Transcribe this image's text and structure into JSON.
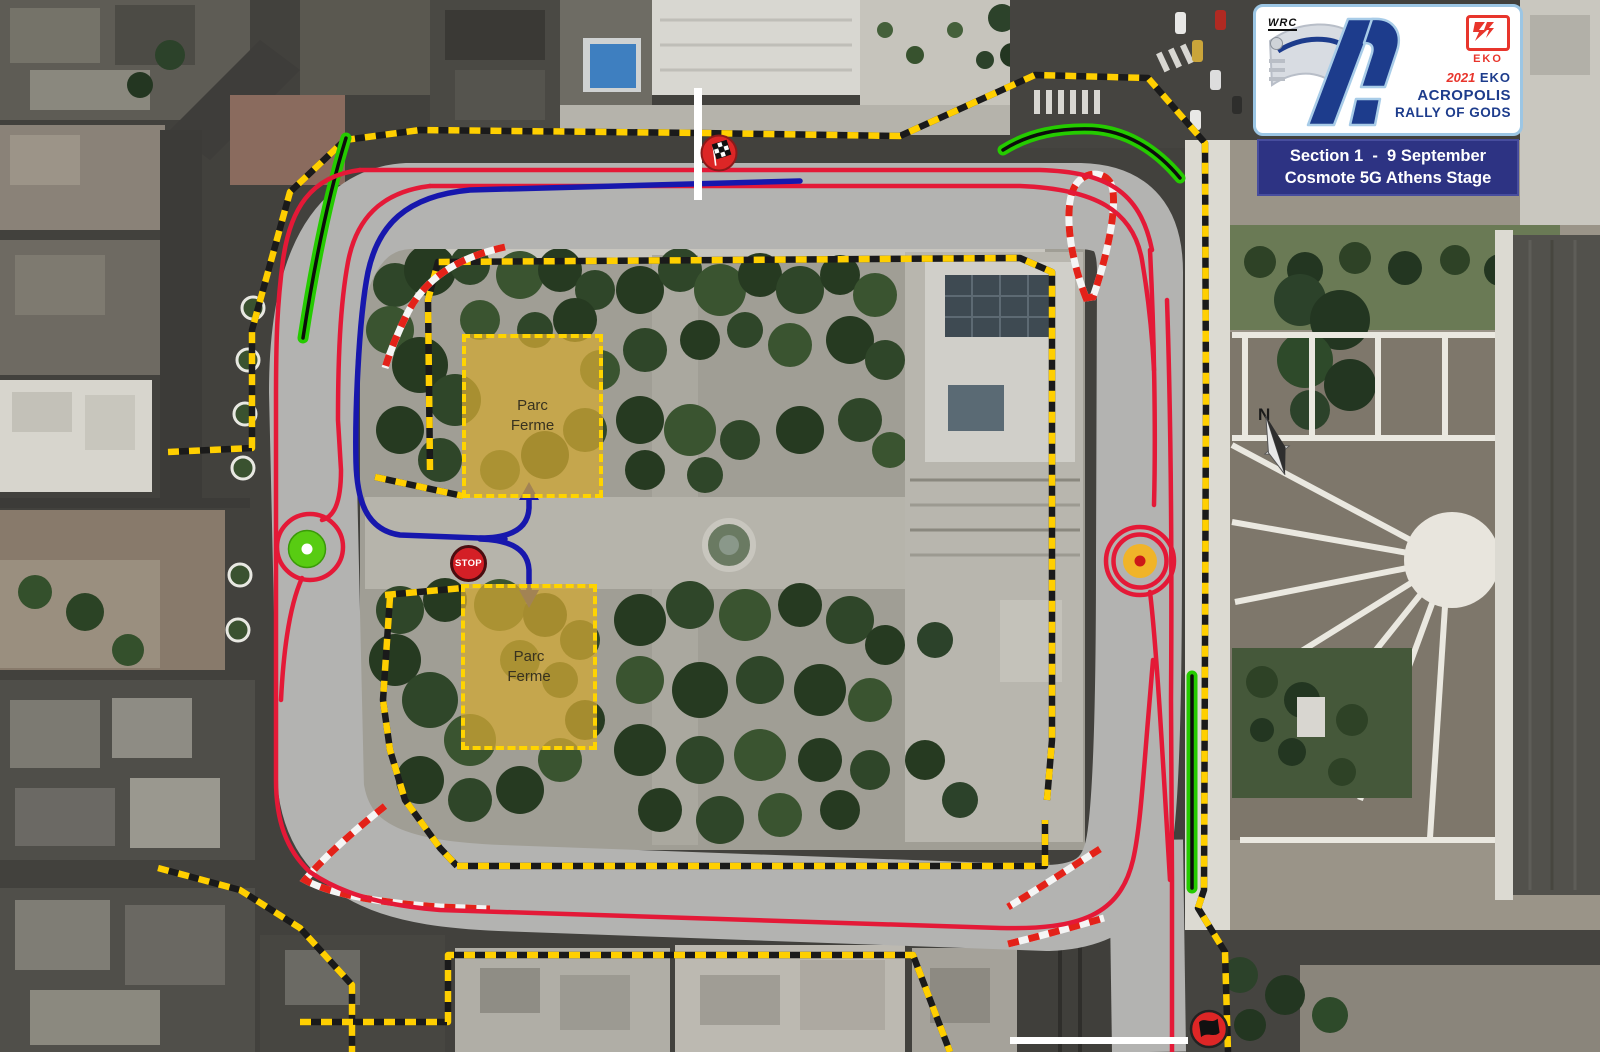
{
  "stage_card": {
    "wrc_mark": "WRC",
    "year": "2021",
    "sponsor": "EKO",
    "title_line1": "ACROPOLIS",
    "title_line2": "RALLY OF GODS",
    "eko_logo_text": "EKO",
    "section_line": "Section 1  -  9 September",
    "stage_line": "Cosmote 5G Athens Stage"
  },
  "map": {
    "labels": {
      "parc_ferme_upper": "Parc\nFerme",
      "parc_ferme_lower": "Parc\nFerme",
      "stop_control": "STOP",
      "north": "N"
    },
    "icons": [
      "checkered-flag-icon",
      "stop-sign-icon",
      "start-control-green-icon",
      "regroup-control-orange-icon",
      "black-flag-icon",
      "north-compass-icon"
    ],
    "colors": {
      "route_red": "#e41937",
      "service_route_blue": "#1717ad",
      "barrier_tape_yellow": "#ffcf00",
      "spectator_zone_green": "#25cb00",
      "chicane_red_white": "#e32219",
      "track_surface": "#b3b3b1",
      "parc_ferme_fill": "#d2a834",
      "banner_navy": "#2d3383",
      "logo_navy": "#1d3c8c",
      "eko_red": "#e8352c"
    }
  }
}
